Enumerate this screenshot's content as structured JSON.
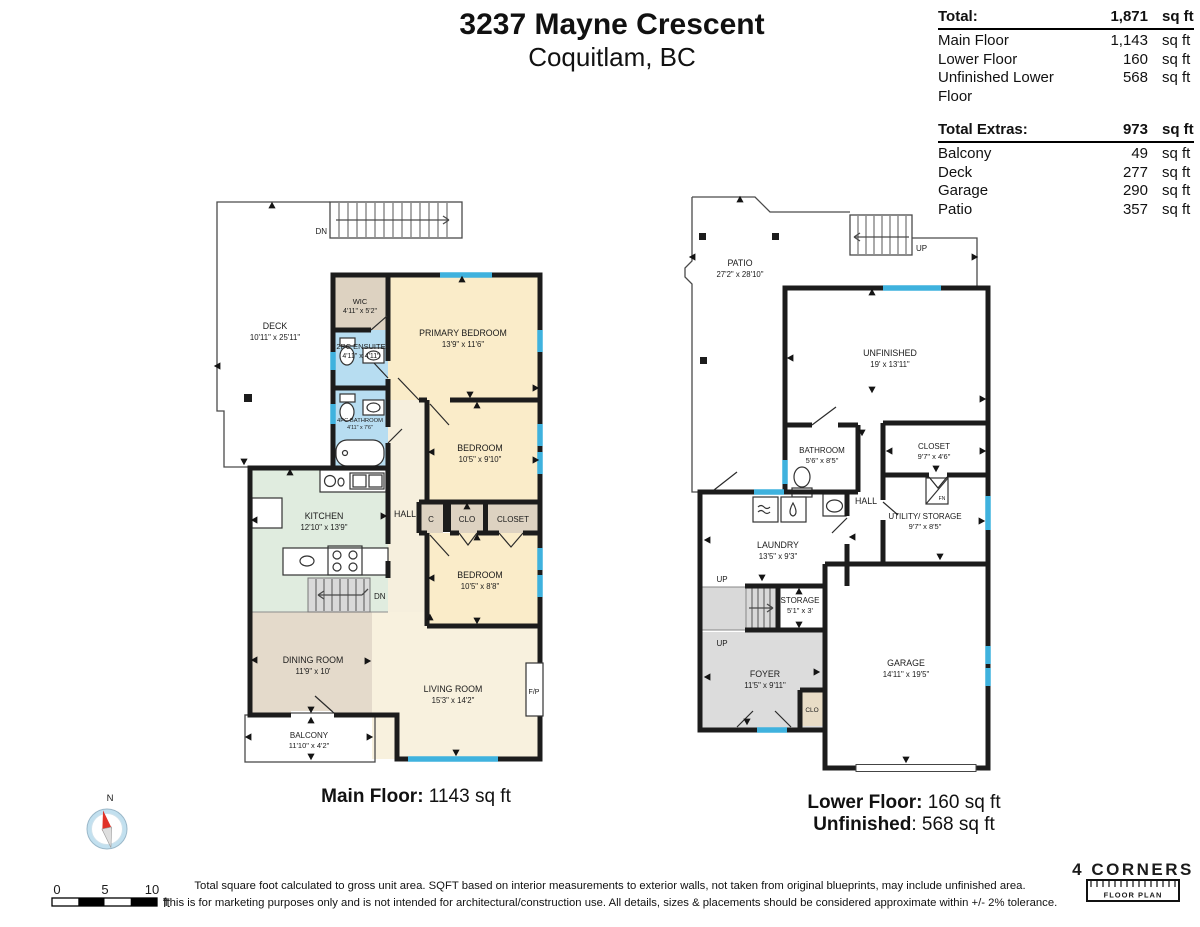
{
  "title": {
    "address": "3237 Mayne Crescent",
    "city": "Coquitlam, BC"
  },
  "area_table": {
    "total": {
      "label": "Total:",
      "value": "1,871",
      "unit": "sq ft"
    },
    "rows1": [
      {
        "label": "Main Floor",
        "value": "1,143",
        "unit": "sq ft"
      },
      {
        "label": "Lower Floor",
        "value": "160",
        "unit": "sq ft"
      },
      {
        "label": "Unfinished Lower Floor",
        "value": "568",
        "unit": "sq ft"
      }
    ],
    "extras": {
      "label": "Total Extras:",
      "value": "973",
      "unit": "sq ft"
    },
    "rows2": [
      {
        "label": "Balcony",
        "value": "49",
        "unit": "sq ft"
      },
      {
        "label": "Deck",
        "value": "277",
        "unit": "sq ft"
      },
      {
        "label": "Garage",
        "value": "290",
        "unit": "sq ft"
      },
      {
        "label": "Patio",
        "value": "357",
        "unit": "sq ft"
      }
    ]
  },
  "main_floor": {
    "caption_label": "Main Floor:",
    "caption_value": " 1143 sq ft",
    "deck": {
      "name": "DECK",
      "dims": "10'11\" x 25'11\""
    },
    "stairs_top": "DN",
    "wic": {
      "name": "WIC",
      "dims": "4'11\" x 5'2\""
    },
    "primary": {
      "name": "PRIMARY BEDROOM",
      "dims": "13'9\" x 11'6\""
    },
    "ensuite": {
      "name": "2PC ENSUITE",
      "dims": "4'11\" x 4'11\""
    },
    "bathroom": {
      "name": "4PC BATHROOM",
      "dims": "4'11\" x 7'6\""
    },
    "bedroom2": {
      "name": "BEDROOM",
      "dims": "10'5\" x 9'10\""
    },
    "kitchen": {
      "name": "KITCHEN",
      "dims": "12'10\" x 13'9\""
    },
    "hall": "HALL",
    "c": "C",
    "clo": "CLO",
    "closet": "CLOSET",
    "bedroom3": {
      "name": "BEDROOM",
      "dims": "10'5\" x 8'8\""
    },
    "stairs_mid": "DN",
    "dining": {
      "name": "DINING ROOM",
      "dims": "11'9\" x 10'"
    },
    "living": {
      "name": "LIVING ROOM",
      "dims": "15'3\" x 14'2\""
    },
    "fireplace": "F/P",
    "balcony": {
      "name": "BALCONY",
      "dims": "11'10\" x 4'2\""
    }
  },
  "lower_floor": {
    "caption1_label": "Lower Floor:",
    "caption1_value": " 160 sq ft",
    "caption2_label": "Unfinished",
    "caption2_value": ": 568 sq ft",
    "patio": {
      "name": "PATIO",
      "dims": "27'2\" x 28'10\""
    },
    "stairs_top": "UP",
    "unfinished": {
      "name": "UNFINISHED",
      "dims": "19' x 13'11\""
    },
    "bathroom": {
      "name": "BATHROOM",
      "dims": "5'6\" x 8'5\""
    },
    "closet": {
      "name": "CLOSET",
      "dims": "9'7\" x 4'6\""
    },
    "hall": "HALL",
    "utility": {
      "name": "UTILITY/ STORAGE",
      "dims": "9'7\" x 8'5\""
    },
    "furnace": "FN",
    "laundry": {
      "name": "LAUNDRY",
      "dims": "13'5\" x 9'3\""
    },
    "up1": "UP",
    "up2": "UP",
    "storage": {
      "name": "STORAGE",
      "dims": "5'1\" x 3'"
    },
    "foyer": {
      "name": "FOYER",
      "dims": "11'5\" x 9'11\""
    },
    "clo": "CLO",
    "garage": {
      "name": "GARAGE",
      "dims": "14'11\" x 19'5\""
    }
  },
  "compass": {
    "north": "N"
  },
  "scale_bar": {
    "t0": "0",
    "t5": "5",
    "t10": "10",
    "unit": "ft"
  },
  "disclaimer": {
    "line1": "Total square foot calculated to gross unit area. SQFT based on interior measurements to exterior walls, not taken from original blueprints, may include unfinished area.",
    "line2": "This is for marketing purposes only and is not intended for architectural/construction use.  All details, sizes & placements should be considered approximate within +/- 2%  tolerance."
  },
  "logo": {
    "brand": "4 CORNERS",
    "sub": "FLOOR PLAN"
  },
  "colors": {
    "wall": "#1c1c1c",
    "window": "#3fb2de",
    "bedroom": "#faecc9",
    "closet": "#ddd2c1",
    "bath": "#b7ddf1",
    "kitchen": "#e0ecdf",
    "dining": "#e4dacb",
    "living": "#f8f1de",
    "hall": "#f6efdd",
    "foyer": "#dcdcdc",
    "stairs": "#d9d9d9",
    "clo": "#e8dcc6"
  }
}
